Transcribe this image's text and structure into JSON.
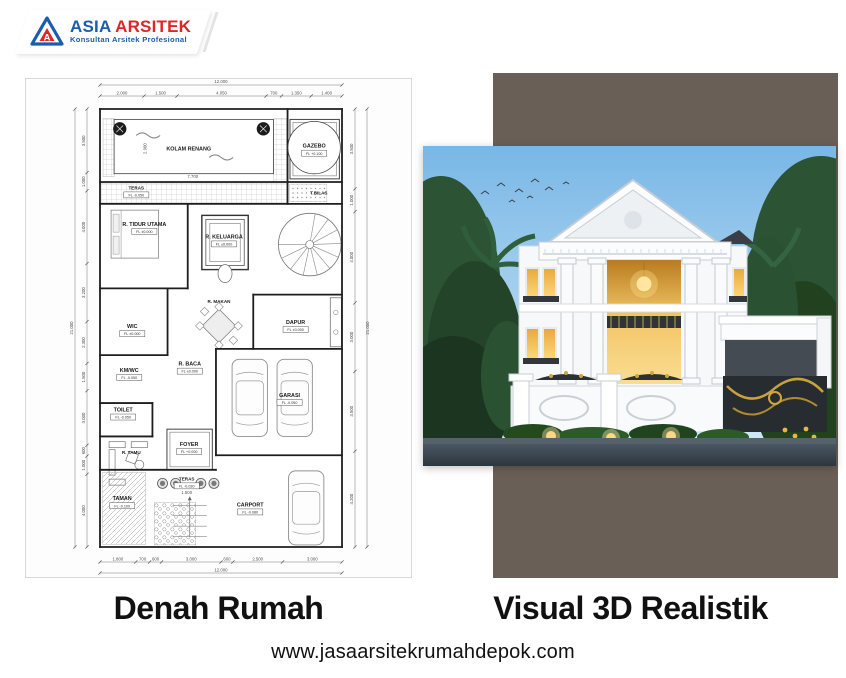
{
  "colors": {
    "brand-blue": "#1a5dab",
    "brand-red": "#e02428",
    "backdrop": "#6a5f57",
    "ink": "#111111"
  },
  "logo": {
    "brand_primary": "ASIA",
    "brand_secondary": "ARSITEK",
    "tagline": "Konsultan Arsitek Profesional"
  },
  "captions": {
    "left": "Denah Rumah",
    "right": "Visual 3D Realistik"
  },
  "footer": {
    "website": "www.jasaarsitekrumahdepok.com"
  },
  "floor_plan": {
    "site": {
      "width_m": 12,
      "height_m": 21
    },
    "overall_dims": {
      "top": "12.000",
      "bottom": "12.000",
      "left": "21.000",
      "right": "21.000"
    },
    "top_dims": [
      "2.000",
      "1.500",
      "4.050",
      "700",
      "1.350",
      "1.400"
    ],
    "bottom_dims": [
      "1.800",
      "700",
      "600",
      "3.000",
      "600",
      "2.500",
      "3.000"
    ],
    "left_dims": [
      "3.500",
      "1.000",
      "4.000",
      "3.200",
      "2.300",
      "1.500",
      "3.000",
      "600",
      "1.000",
      "4.000"
    ],
    "right_dims": [
      "3.500",
      "1.000",
      "4.000",
      "3.000",
      "3.500",
      "4.200"
    ],
    "inner_dims": [
      {
        "label": "7.700",
        "x": 4.6,
        "y": 3.32
      },
      {
        "label": "2.900",
        "x": 2.3,
        "y": 1.9,
        "rot": true
      },
      {
        "label": "1.500",
        "x": 4.3,
        "y": 18.45
      }
    ],
    "rooms": [
      {
        "name": "KOLAM RENANG",
        "x": 4.4,
        "y": 2.0
      },
      {
        "name": "GAZEBO",
        "sub": "FL +0.100",
        "x": 10.62,
        "y": 1.85,
        "circle": 1.3
      },
      {
        "name": "TERAS",
        "sub": "FL -0.050",
        "x": 1.8,
        "y": 3.85,
        "small": true
      },
      {
        "name": "T.BILAS",
        "x": 10.85,
        "y": 4.1,
        "small": true
      },
      {
        "name": "R. TIDUR UTAMA",
        "sub": "FL ±0.000",
        "x": 2.2,
        "y": 5.6
      },
      {
        "name": "R. KELUARGA",
        "sub": "FL ±0.000",
        "x": 6.15,
        "y": 6.2
      },
      {
        "name": "WIC",
        "sub": "FL ±0.000",
        "x": 1.6,
        "y": 10.5
      },
      {
        "name": "R. MAKAN",
        "x": 5.9,
        "y": 9.3,
        "small": true
      },
      {
        "name": "DAPUR",
        "sub": "FL ±0.000",
        "x": 9.7,
        "y": 10.3
      },
      {
        "name": "R. BACA",
        "sub": "FL ±0.000",
        "x": 4.45,
        "y": 12.3
      },
      {
        "name": "KM/WC",
        "sub": "FL -0.050",
        "x": 1.45,
        "y": 12.6
      },
      {
        "name": "TOILET",
        "sub": "FL -0.050",
        "x": 1.15,
        "y": 14.5
      },
      {
        "name": "R. TAMU",
        "x": 1.55,
        "y": 16.55,
        "small": true
      },
      {
        "name": "FOYER",
        "sub": "FL +0.000",
        "x": 4.42,
        "y": 16.15
      },
      {
        "name": "GARASI",
        "sub": "FL -0.050",
        "x": 9.4,
        "y": 13.8
      },
      {
        "name": "TERAS",
        "sub": "FL -0.030",
        "x": 4.3,
        "y": 17.8,
        "small": true
      },
      {
        "name": "TAMAN",
        "sub": "FL -0.100",
        "x": 1.1,
        "y": 18.75
      },
      {
        "name": "CARPORT",
        "sub": "FL -0.080",
        "x": 7.45,
        "y": 19.05
      }
    ],
    "walls": [
      [
        0,
        0,
        12,
        0
      ],
      [
        12,
        0,
        12,
        21
      ],
      [
        12,
        21,
        0,
        21
      ],
      [
        0,
        21,
        0,
        0
      ],
      [
        0,
        3.5,
        12,
        3.5
      ],
      [
        0,
        4.55,
        12,
        4.55
      ],
      [
        9.3,
        0,
        9.3,
        4.55
      ],
      [
        4.35,
        4.55,
        4.35,
        8.6
      ],
      [
        0,
        8.6,
        4.35,
        8.6
      ],
      [
        3.35,
        8.6,
        3.35,
        11.8
      ],
      [
        0,
        11.8,
        3.35,
        11.8
      ],
      [
        7.6,
        8.9,
        7.6,
        11.5
      ],
      [
        7.6,
        8.9,
        12,
        8.9
      ],
      [
        5.75,
        11.5,
        12,
        11.5
      ],
      [
        5.75,
        11.5,
        5.75,
        16.6
      ],
      [
        5.75,
        16.6,
        12,
        16.6
      ],
      [
        0,
        14.1,
        2.6,
        14.1
      ],
      [
        2.6,
        14.1,
        2.6,
        15.7
      ],
      [
        0,
        15.7,
        2.6,
        15.7
      ],
      [
        0,
        17.3,
        5.75,
        17.3
      ]
    ],
    "features": [
      {
        "type": "grid",
        "x": 0.15,
        "y": 0.45,
        "w": 0.55,
        "h": 2.8
      },
      {
        "type": "grid",
        "x": 8.62,
        "y": 0.45,
        "w": 0.68,
        "h": 3.05
      },
      {
        "type": "grid",
        "x": 0,
        "y": 3.55,
        "w": 9.3,
        "h": 0.95
      },
      {
        "type": "pool",
        "x": 0.7,
        "y": 0.5,
        "w": 7.9,
        "h": 2.6
      },
      {
        "type": "dark-circle",
        "x": 0.98,
        "y": 0.95,
        "r": 0.33
      },
      {
        "type": "dark-circle",
        "x": 8.1,
        "y": 0.95,
        "r": 0.33
      },
      {
        "type": "rect2",
        "x": 9.42,
        "y": 0.5,
        "w": 2.45,
        "h": 2.85
      },
      {
        "type": "dots",
        "x": 9.4,
        "y": 3.6,
        "w": 1.85,
        "h": 0.85
      },
      {
        "type": "bed",
        "x": 0.55,
        "y": 4.85,
        "w": 2.35,
        "h": 2.3
      },
      {
        "type": "nested",
        "x": 5.05,
        "y": 5.1,
        "w": 2.3,
        "h": 2.6
      },
      {
        "type": "spiral",
        "cx": 10.4,
        "cy": 6.5,
        "r": 1.55
      },
      {
        "type": "table",
        "x": 5.9,
        "y": 10.4,
        "r": 0.95
      },
      {
        "type": "counter",
        "x": 11.42,
        "y": 9.05,
        "w": 0.55,
        "h": 2.35
      },
      {
        "type": "car",
        "x": 6.55,
        "y": 12.0,
        "w": 1.75,
        "h": 3.7
      },
      {
        "type": "car",
        "x": 8.78,
        "y": 12.0,
        "w": 1.75,
        "h": 3.7
      },
      {
        "type": "car",
        "x": 9.35,
        "y": 17.35,
        "w": 1.75,
        "h": 3.55
      },
      {
        "type": "sofa",
        "x": 0.45,
        "y": 15.95,
        "w": 2.0,
        "h": 1.7
      },
      {
        "type": "rect2",
        "x": 3.32,
        "y": 15.35,
        "w": 2.25,
        "h": 1.95
      },
      {
        "type": "hatch",
        "x": 0.12,
        "y": 17.42,
        "w": 2.15,
        "h": 3.45
      },
      {
        "type": "pebble",
        "x": 2.7,
        "y": 18.85,
        "w": 2.05,
        "h": 2.05
      },
      {
        "type": "planter",
        "x": 3.1,
        "y": 17.95
      },
      {
        "type": "planter",
        "x": 3.75,
        "y": 17.95
      },
      {
        "type": "planter",
        "x": 5.0,
        "y": 17.95
      },
      {
        "type": "planter",
        "x": 5.65,
        "y": 17.95
      },
      {
        "type": "steps",
        "x": 3.6,
        "y": 19.0,
        "w": 1.7,
        "h": 1.5
      }
    ]
  }
}
